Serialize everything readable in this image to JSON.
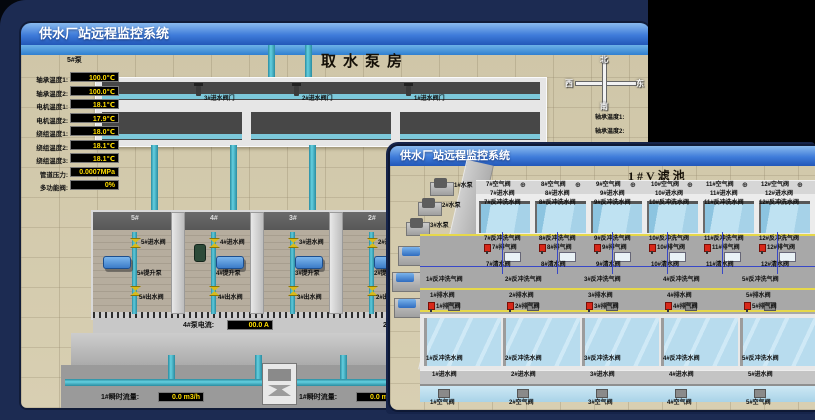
{
  "colors": {
    "background": "#1c2b52",
    "titlebar_top": "#8abbee",
    "titlebar_bottom": "#2257b8",
    "value_text": "#ffdd00",
    "alarm_red": "#d8281a",
    "pipe_teal": "#45b8cc",
    "valve_yellow": "#d8bb1c"
  },
  "back_window": {
    "title": "供水厂站远程监控系统",
    "scene_title": "取水泵房",
    "top_valves": [
      "3#进水阀门",
      "2#进水阀门",
      "1#进水阀门"
    ],
    "compass": {
      "north": "北",
      "west": "西",
      "south": "南",
      "east": "东"
    },
    "panel": {
      "header": "5#泵",
      "rows": [
        {
          "label": "轴承温度1:",
          "value": "100.0℃"
        },
        {
          "label": "轴承温度2:",
          "value": "100.0℃"
        },
        {
          "label": "电机温度1:",
          "value": "18.1℃"
        },
        {
          "label": "电机温度2:",
          "value": "17.9℃"
        },
        {
          "label": "绕组温度1:",
          "value": "18.0℃"
        },
        {
          "label": "绕组温度2:",
          "value": "18.1℃"
        },
        {
          "label": "绕组温度3:",
          "value": "18.1℃"
        },
        {
          "label": "管道压力:",
          "value": "0.0007MPa"
        },
        {
          "label": "多功能阀:",
          "value": "0%"
        }
      ]
    },
    "right_labels": [
      "轴承温度1:",
      "轴承温度2:"
    ],
    "bays": [
      {
        "number": "5#",
        "inlet": "5#进水阀",
        "pump": "5#提升泵",
        "outlet": "5#出水阀"
      },
      {
        "number": "4#",
        "inlet": "4#进水阀",
        "pump": "4#提升泵",
        "outlet": "4#出水阀"
      },
      {
        "number": "3#",
        "inlet": "3#进水阀",
        "pump": "3#提升泵",
        "outlet": "3#出水阀"
      },
      {
        "number": "2#",
        "inlet": "2#进水阀",
        "pump": "2#提升泵",
        "outlet": "2#出水阀"
      }
    ],
    "current_left": {
      "label": "4#泵电流:",
      "value": "00.0 A"
    },
    "current_right": {
      "label": "2#泵电流"
    },
    "flow_left": {
      "label": "1#瞬时流量:",
      "value": "0.0 m3/h"
    },
    "flow_right": {
      "label": "1#瞬时流量:",
      "value": "0.0 m3/h"
    }
  },
  "front_window": {
    "title": "供水厂站远程监控系统",
    "scene_title": "1#V滤池",
    "equipment": [
      {
        "label": "1#水泵"
      },
      {
        "label": "2#水泵"
      },
      {
        "label": "3#水泵"
      },
      {
        "label": "1#风机"
      },
      {
        "label": "2#风机"
      },
      {
        "label": "3#风机"
      }
    ],
    "upper_cells": [
      {
        "air": "7#空气阀",
        "inlet": "7#进水阀",
        "bw_water": "7#反冲洗水阀",
        "bw_air": "7#反冲洗气阀",
        "exhaust": "7#排气阀",
        "clean": "7#清水阀"
      },
      {
        "air": "8#空气阀",
        "inlet": "8#进水阀",
        "bw_water": "8#反冲洗水阀",
        "bw_air": "8#反冲洗气阀",
        "exhaust": "8#排气阀",
        "clean": "8#清水阀"
      },
      {
        "air": "9#空气阀",
        "inlet": "9#进水阀",
        "bw_water": "9#反冲洗水阀",
        "bw_air": "9#反冲洗气阀",
        "exhaust": "9#排气阀",
        "clean": "9#清水阀"
      },
      {
        "air": "10#空气阀",
        "inlet": "10#进水阀",
        "bw_water": "10#反冲洗水阀",
        "bw_air": "10#反冲洗气阀",
        "exhaust": "10#排气阀",
        "clean": "10#清水阀"
      },
      {
        "air": "11#空气阀",
        "inlet": "11#进水阀",
        "bw_water": "11#反冲洗水阀",
        "bw_air": "11#反冲洗气阀",
        "exhaust": "11#排气阀",
        "clean": "11#清水阀"
      },
      {
        "air": "12#空气阀",
        "inlet": "12#进水阀",
        "bw_water": "12#反冲洗水阀",
        "bw_air": "12#反冲洗气阀",
        "exhaust": "12#排气阀",
        "clean": "12#清水阀"
      }
    ],
    "lower_cells": [
      {
        "bw_air": "1#反冲洗气阀",
        "drain": "1#排水阀",
        "exhaust": "1#排气阀",
        "bw_water": "1#反冲洗水阀",
        "inlet": "1#进水阀",
        "air": "1#空气阀"
      },
      {
        "bw_air": "2#反冲洗气阀",
        "drain": "2#排水阀",
        "exhaust": "2#排气阀",
        "bw_water": "2#反冲洗水阀",
        "inlet": "2#进水阀",
        "air": "2#空气阀"
      },
      {
        "bw_air": "3#反冲洗气阀",
        "drain": "3#排水阀",
        "exhaust": "3#排气阀",
        "bw_water": "3#反冲洗水阀",
        "inlet": "3#进水阀",
        "air": "3#空气阀"
      },
      {
        "bw_air": "4#反冲洗气阀",
        "drain": "4#排水阀",
        "exhaust": "4#排气阀",
        "bw_water": "4#反冲洗水阀",
        "inlet": "4#进水阀",
        "air": "4#空气阀"
      },
      {
        "bw_air": "5#反冲洗气阀",
        "drain": "5#排水阀",
        "exhaust": "5#排气阀",
        "bw_water": "5#反冲洗水阀",
        "inlet": "5#进水阀",
        "air": "5#空气阀"
      }
    ]
  }
}
